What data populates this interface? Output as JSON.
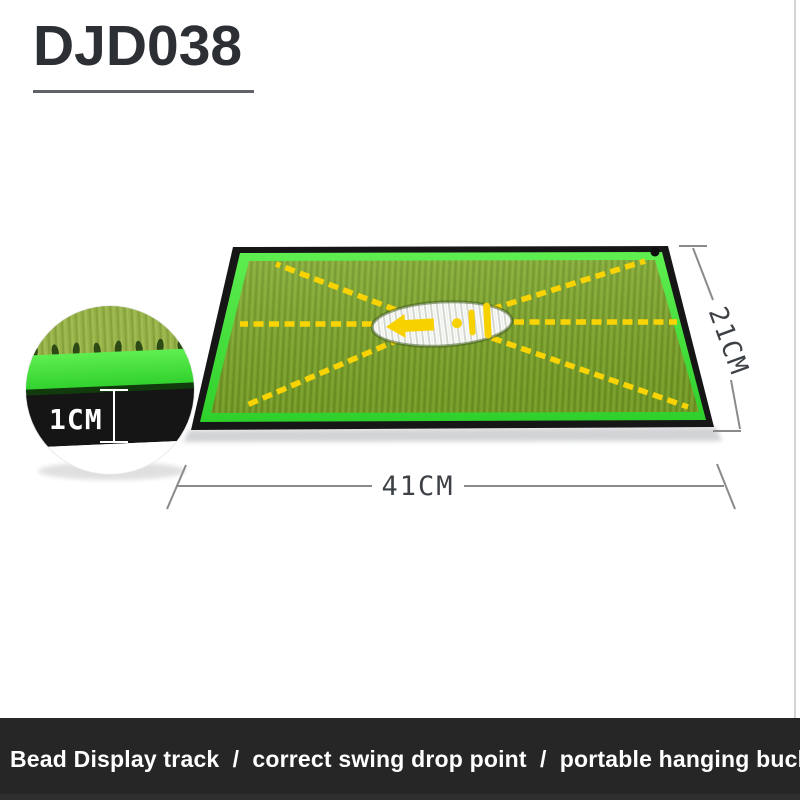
{
  "header": {
    "model_code": "DJD038"
  },
  "annotations": {
    "width_label": "41CM",
    "depth_label": "21CM",
    "thickness_label": "1CM"
  },
  "banner": {
    "text": "Bead Display track  /  correct swing drop point  /  portable hanging buckle"
  },
  "colors": {
    "turf_green": "#7da42b",
    "neon_edge_green": "#42e03a",
    "rubber_base_black": "#161616",
    "track_yellow": "#f9d303",
    "bead_white": "#ffffff",
    "banner_background": "#262626",
    "banner_text": "#ffffff",
    "title_text": "#2c2f34",
    "dimension_line_gray": "#8a8a8a"
  }
}
